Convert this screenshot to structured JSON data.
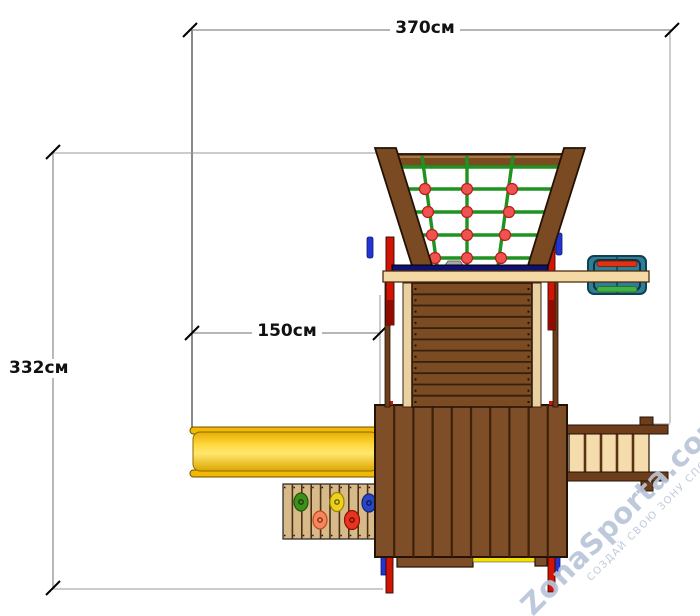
{
  "diagram": {
    "dimensions": {
      "total_width": "370см",
      "total_depth": "332см",
      "slide_length": "150см"
    },
    "watermark": {
      "brand": "ZonaSporta.com",
      "slogan": "СОЗДАЙ СВОЮ ЗОНУ СПОРТА"
    },
    "palette": {
      "wood_brown": "#7b4b24",
      "wood_tan": "#f4d9a4",
      "slide_yellow": "#ffd83e",
      "net_green": "#1f9220",
      "net_knot_red": "#ef5350",
      "accent_red": "#d01505",
      "accent_blue": "#2334d4",
      "accessory_teal": "#2f7e99",
      "dimension_line_gray": "#8a8a8a",
      "watermark_blue": "#b9c6d9"
    }
  }
}
